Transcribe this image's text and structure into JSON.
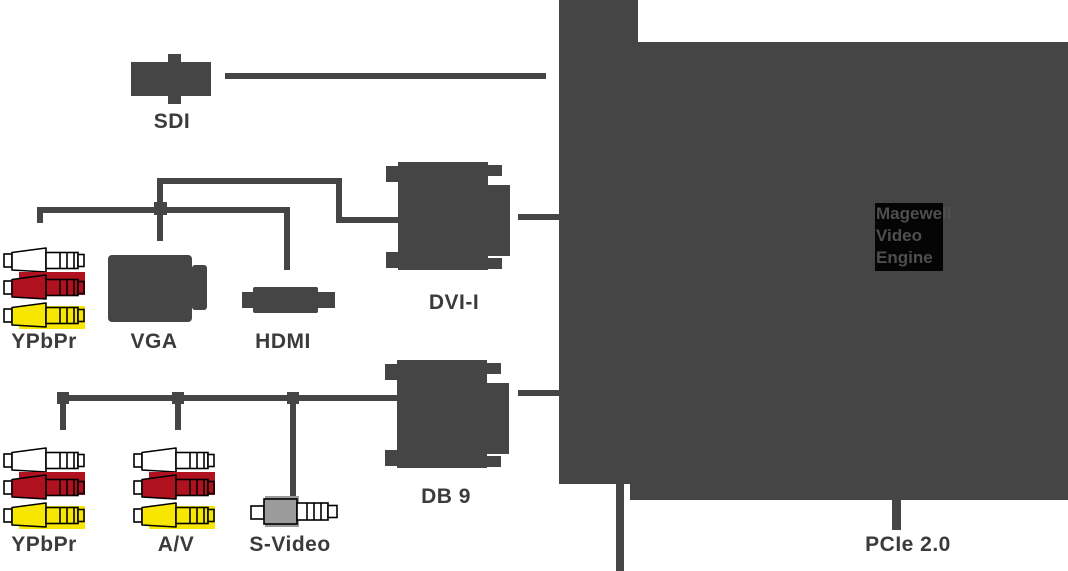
{
  "colors": {
    "dark": "#454545",
    "label": "#3b3b3b",
    "red": "#b0111f",
    "yellow": "#f7e600",
    "svideo": "#9b9b9b",
    "chipbg": "#050505",
    "chiptext": "#4f4f4f"
  },
  "labels": {
    "sdi": "SDI",
    "ypbpr_top": "YPbPr",
    "vga": "VGA",
    "hdmi": "HDMI",
    "dvi": "DVI-I",
    "ypbpr_bottom": "YPbPr",
    "av": "A/V",
    "svideo": "S-Video",
    "db9": "DB 9",
    "pcie": "PCIe 2.0"
  },
  "chip": {
    "line1": "Magewell",
    "line2": "Video",
    "line3": "Engine"
  }
}
